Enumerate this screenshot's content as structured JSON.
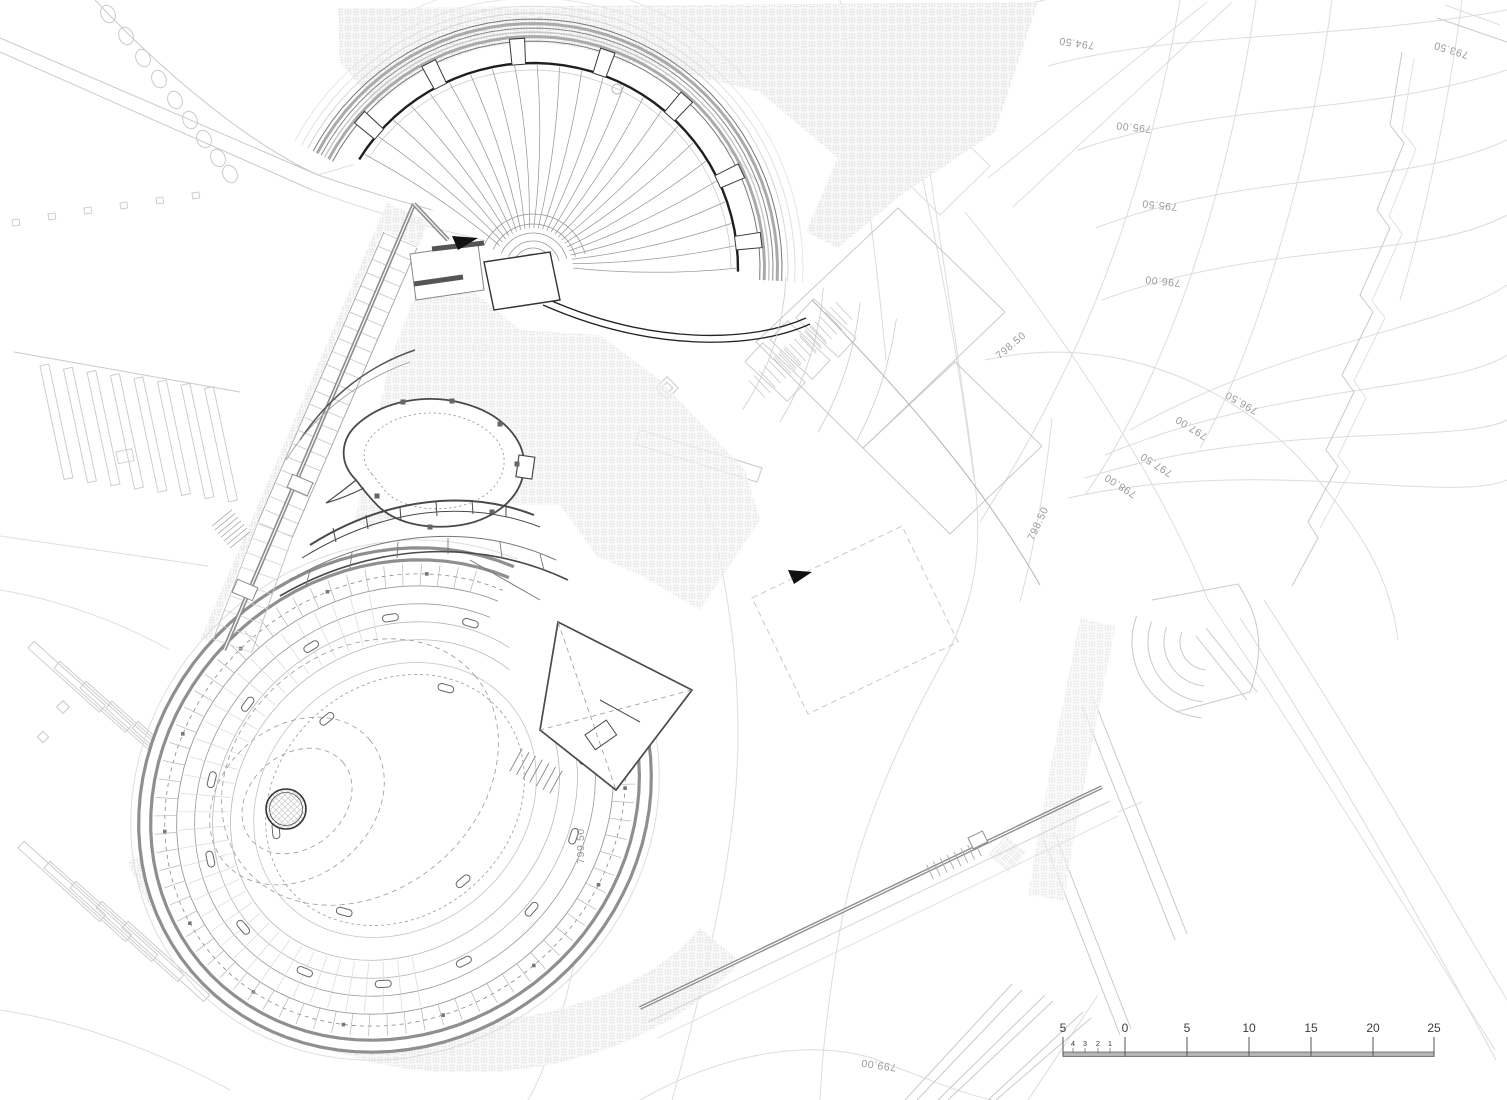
{
  "plan": {
    "contour_labels": [
      {
        "text": "794.50"
      },
      {
        "text": "793.50"
      },
      {
        "text": "795.00"
      },
      {
        "text": "795.50"
      },
      {
        "text": "796.00"
      },
      {
        "text": "796.50"
      },
      {
        "text": "797.00"
      },
      {
        "text": "797.50"
      },
      {
        "text": "798.00"
      },
      {
        "text": "798.50"
      },
      {
        "text": "798.50"
      },
      {
        "text": "799.50"
      },
      {
        "text": "799.00"
      }
    ]
  },
  "scale_bar": {
    "major_labels": [
      "5",
      "0",
      "5",
      "10",
      "15",
      "20",
      "25"
    ],
    "minor_labels": [
      "4",
      "3",
      "2",
      "1"
    ]
  },
  "colors": {
    "paper": "#ffffff",
    "contour": "#dcdcdc",
    "context": "#c9c9c9",
    "context_light": "#dedede",
    "wall_gray": "#8f8f8f",
    "line_dark": "#1f1f1f",
    "line_mid": "#4a4a4a",
    "seat_line": "#9a9a9a",
    "tick_gray": "#b5b5b5",
    "hatch": "#e4e4e4",
    "label_gray": "#9a9a9a"
  }
}
